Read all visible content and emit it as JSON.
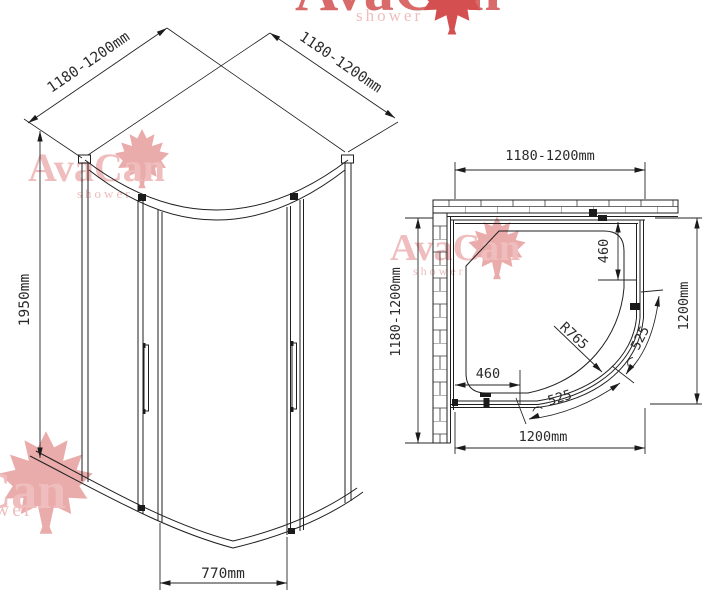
{
  "brand": {
    "name": "AvaCan",
    "tagline": "shower"
  },
  "iso_view": {
    "dim_back_left": "1180-1200mm",
    "dim_back_right": "1180-1200mm",
    "dim_height": "1950mm",
    "dim_door_opening": "770mm"
  },
  "plan_view": {
    "dim_width_top": "1180-1200mm",
    "dim_depth_left": "1180-1200mm",
    "dim_width_bottom": "1200mm",
    "dim_depth_right": "1200mm",
    "dim_fixed_panel_right": "460",
    "dim_fixed_panel_bottom": "460",
    "dim_door_radius": "R765",
    "dim_door_arc_right": "525",
    "dim_door_arc_bottom": "525"
  },
  "colors": {
    "drawing_line": "#1f1f1f",
    "dimension_text": "#2b2b2b",
    "watermark_text_light": "#efbdbd",
    "watermark_text_strong": "#d96a6a",
    "watermark_leaf_light": "#eaabab",
    "watermark_leaf_strong": "#d45050",
    "background": "#ffffff"
  }
}
